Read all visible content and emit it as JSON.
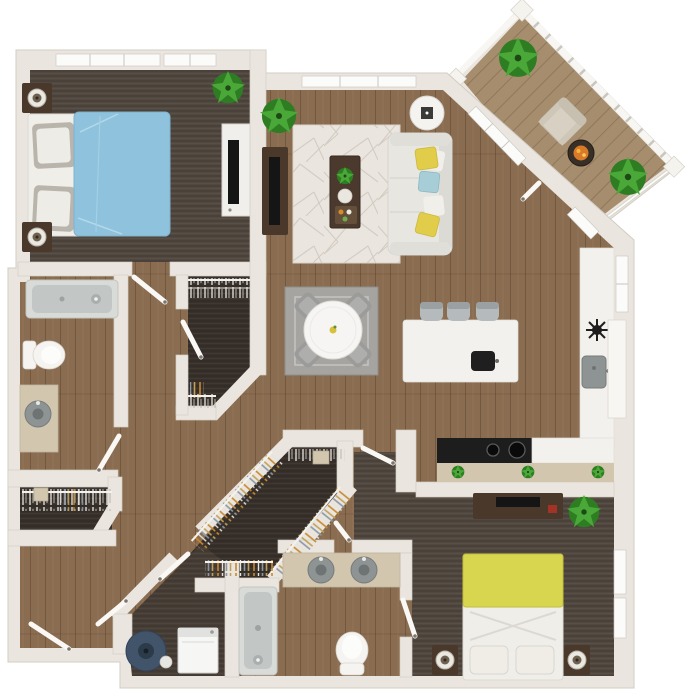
{
  "scene": {
    "kind": "apartment-floor-plan-3d-top-view",
    "style": "rendered color floor plan, no text labels"
  },
  "colors": {
    "wall": "#eae6df",
    "wall_edge": "#d2cdc3",
    "window": "#fbfbfa",
    "door": "#f9f8f5",
    "floor_main": "#8a6c50",
    "floor_bedroom": "#51483f",
    "floor_closet": "#38302a",
    "floor_laundry": "#473e36",
    "floor_balcony": "#a68d6e",
    "rug_living": "#eae5df",
    "rug_dining": "#a5a4a1",
    "sofa": "#e7e6e1",
    "pillow_yellow": "#e2cd4a",
    "pillow_blue": "#a7cdd7",
    "bed_blue": "#8fc2dc",
    "bed_yellow": "#d8d54e",
    "bedding_white": "#f0eee9",
    "wood_dark": "#4a392b",
    "dresser_white": "#f1efeb",
    "marble": "#f2f1ed",
    "counter_tan": "#d2c6ae",
    "cooktop": "#1d1d1d",
    "porcelain": "#f5f4f0",
    "fixture": "#c2c6c5",
    "fixture_deep": "#a9afae",
    "sink_gray": "#8e9493",
    "plant": "#4aa838",
    "plant_dark": "#2e7d22",
    "stool": "#b5babc",
    "chair": "#9b9b99",
    "table_white": "#f6f5f3",
    "washer": "#f6f6f4",
    "basket": "#415469",
    "tv": "#151515",
    "accent_orange": "#d97a28"
  },
  "rooms": [
    {
      "id": "bedroom-1",
      "furniture": [
        "bed-blue-duvet",
        "nightstand",
        "table-lamp",
        "nightstand",
        "table-lamp",
        "dresser",
        "tv",
        "plant"
      ]
    },
    {
      "id": "living-room",
      "furniture": [
        "sofa",
        "throw-pillows",
        "area-rug",
        "coffee-table",
        "tv-console",
        "tv",
        "round-side-table",
        "plant"
      ]
    },
    {
      "id": "dining-area",
      "furniture": [
        "round-dining-table",
        "dining-chair",
        "dining-chair",
        "dining-chair",
        "dining-chair",
        "rug"
      ]
    },
    {
      "id": "kitchen",
      "furniture": [
        "island",
        "bar-stool",
        "bar-stool",
        "bar-stool",
        "island-sink",
        "cooktop",
        "counter",
        "kitchen-sink",
        "refrigerator",
        "herb-plants"
      ]
    },
    {
      "id": "balcony",
      "furniture": [
        "lounge-chair",
        "fire-table",
        "plant",
        "plant"
      ]
    },
    {
      "id": "bathroom-1",
      "furniture": [
        "bathtub",
        "toilet",
        "vanity-sink"
      ]
    },
    {
      "id": "bathroom-2",
      "furniture": [
        "double-vanity",
        "bathtub",
        "toilet"
      ]
    },
    {
      "id": "walk-in-closet-1",
      "furniture": [
        "hanging-rods",
        "clothes"
      ]
    },
    {
      "id": "walk-in-closet-2",
      "furniture": [
        "hanging-rods",
        "clothes",
        "storage-box"
      ]
    },
    {
      "id": "hall-closet",
      "furniture": [
        "hanging-rod",
        "clothes",
        "storage-box"
      ]
    },
    {
      "id": "laundry",
      "furniture": [
        "washer",
        "laundry-basket"
      ]
    },
    {
      "id": "bedroom-2",
      "furniture": [
        "bed-yellow-duvet",
        "nightstand",
        "table-lamp",
        "nightstand",
        "table-lamp",
        "media-console",
        "tv",
        "plant"
      ]
    },
    {
      "id": "hallway",
      "furniture": []
    }
  ]
}
